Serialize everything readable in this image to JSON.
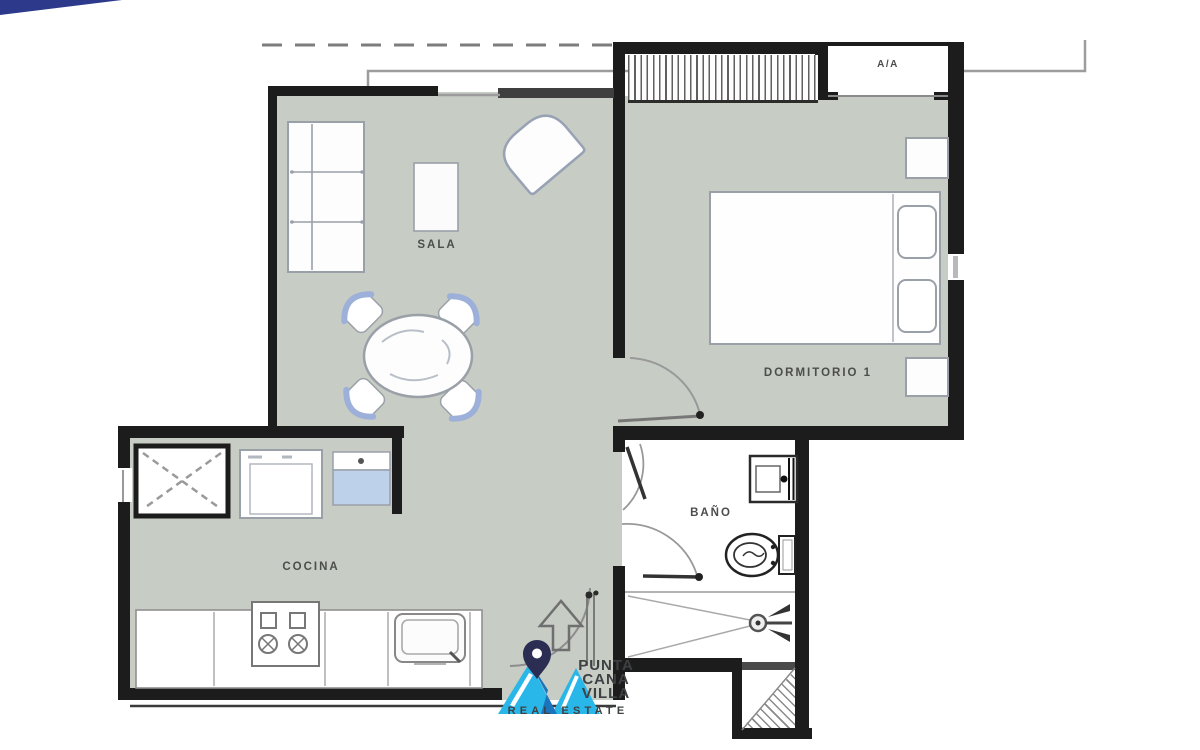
{
  "title": "Apartment floor plan",
  "rooms": {
    "living": "SALA",
    "kitchen": "COCINA",
    "bedroom": "DORMITORIO 1",
    "bathroom": "BAÑO",
    "ac_unit": "A/A"
  },
  "branding": {
    "name_line1": "PUNTA",
    "name_line2": "CANA",
    "name_line3": "VILLA",
    "tagline": "REAL ESTATE"
  },
  "colors": {
    "floor": "#c7ccc4",
    "wall": "#1c1c1c",
    "furniture_line": "#9aa0a8",
    "furniture_accent": "#9db0d9",
    "appliance_blue": "#bdd2ea",
    "window_line": "#9c9c9c",
    "logo_cyan": "#29b6e8",
    "logo_blue": "#1b75bc",
    "logo_navy": "#2b2e52",
    "corner_banner": "#2d3a8c",
    "label_text": "#4c4e4b"
  }
}
